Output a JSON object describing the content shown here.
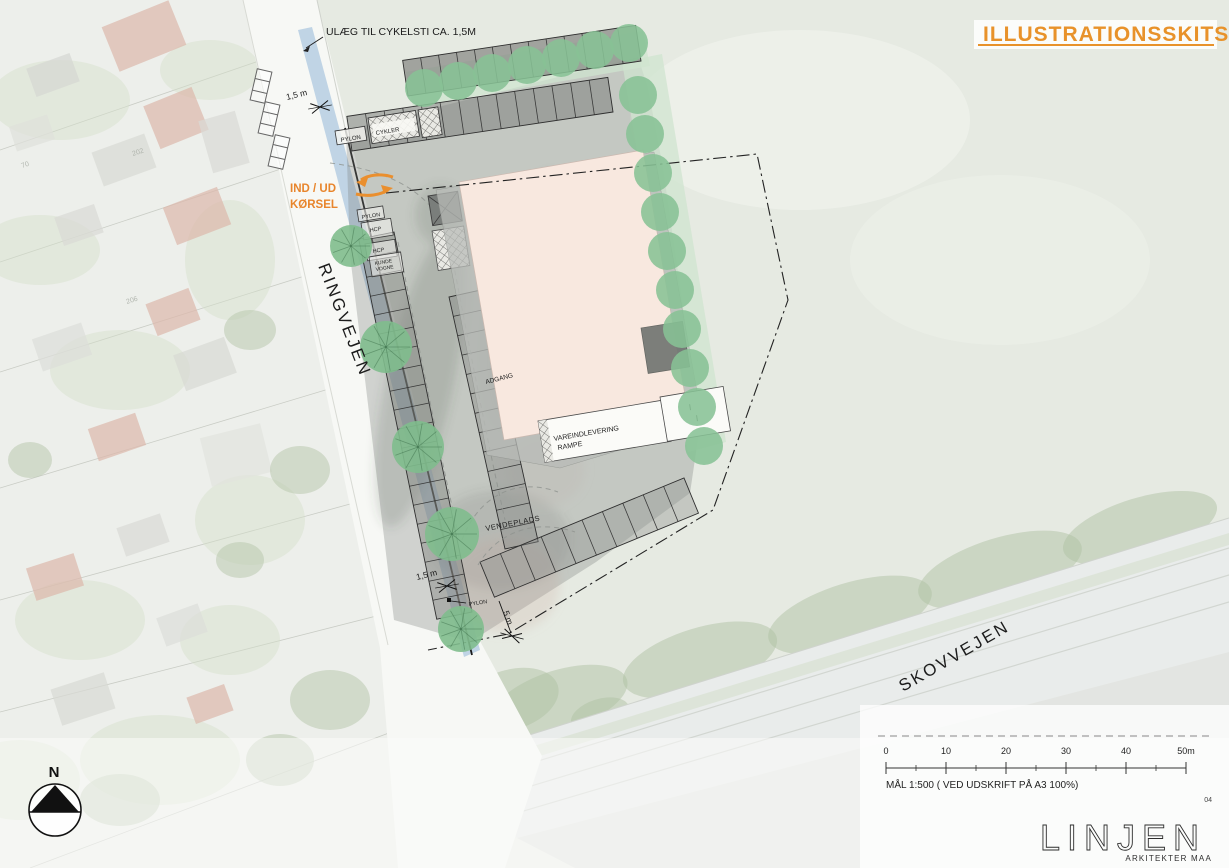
{
  "header": {
    "title": "ILLUSTRATIONSSKITSE",
    "page_number": "04"
  },
  "annotations": {
    "cycle_note": "ULÆG TIL CYKELSTI CA. 1,5M",
    "in_out_line1": "IND / UD",
    "in_out_line2": "KØRSEL",
    "dim_top": "1,5 m",
    "dim_bottom": "1,5 m",
    "dim_pylon": "5 m"
  },
  "roads": {
    "west_road": "RINGVEJEN",
    "south_road": "SKOVVEJEN"
  },
  "site_labels": {
    "pylon_top": "PYLON",
    "cykler": "CYKLER",
    "pylon_west": "PYLON",
    "hcp_1": "HCP",
    "hcp_2": "HCP",
    "kunde_line1": "KUNDE",
    "kunde_line2": "VOGNE",
    "adgang": "ADGANG",
    "delivery_line1": "VAREINDLEVERING",
    "delivery_line2": "RAMPE",
    "vendeplads": "VENDEPLADS",
    "pylon_bottom": "PYLON"
  },
  "footer": {
    "north_label": "N",
    "scale_ticks": [
      "0",
      "10",
      "20",
      "30",
      "40",
      "50m"
    ],
    "scale_caption": "MÅL 1:500 ( VED UDSKRIFT PÅ A3 100%)",
    "logo_text": "LINJEN",
    "logo_sub": "ARKITEKTER MAA"
  },
  "parcel_numbers": [
    {
      "text": "202",
      "x": 133,
      "y": 156,
      "rot": -18
    },
    {
      "text": "70",
      "x": 22,
      "y": 168,
      "rot": -18
    },
    {
      "text": "206",
      "x": 127,
      "y": 304,
      "rot": -18
    }
  ],
  "colors": {
    "accent_orange": "#E8922A",
    "tree_green": "#88C295",
    "tree_band": "#CFE4CF",
    "cycle_blue": "#A8C4DE",
    "building_pink": "#F8E8DF",
    "roof_gray": "#6F7370",
    "road_white": "#F7F8F5",
    "field_green": "#E6EAE2"
  },
  "scene": {
    "parking_rows": [
      {
        "p1": [
          641,
          61
        ],
        "p2": [
          408,
          96
        ],
        "depth": 36,
        "stalls": 13,
        "fill": "rgba(118,120,117,0.62)"
      },
      {
        "p1": [
          613,
          112
        ],
        "p2": [
          352,
          151
        ],
        "depth": 35,
        "stalls": 14,
        "fill": "rgba(128,130,127,0.55)"
      },
      {
        "p1": [
          394,
          232
        ],
        "p2": [
          472,
          612
        ],
        "depth": 36,
        "stalls": 20,
        "fill": "rgba(130,132,129,0.45)"
      },
      {
        "p1": [
          505,
          549
        ],
        "p2": [
          449,
          297
        ],
        "depth": 34,
        "stalls": 13,
        "fill": "rgba(134,136,133,0.42)"
      },
      {
        "p1": [
          480,
          562
        ],
        "p2": [
          684,
          478
        ],
        "depth": 38,
        "stalls": 10,
        "fill": "rgba(146,148,144,0.40)"
      }
    ],
    "tree_radius": 19,
    "trees_row": [
      [
        424,
        88
      ],
      [
        458,
        81
      ],
      [
        492,
        73
      ],
      [
        527,
        65
      ],
      [
        561,
        58
      ],
      [
        595,
        50
      ],
      [
        629,
        43
      ],
      [
        638,
        95
      ],
      [
        645,
        134
      ],
      [
        653,
        173
      ],
      [
        660,
        212
      ],
      [
        667,
        251
      ],
      [
        675,
        290
      ],
      [
        682,
        329
      ],
      [
        690,
        368
      ],
      [
        697,
        407
      ],
      [
        704,
        446
      ]
    ],
    "trees_west": [
      [
        351,
        246,
        21
      ],
      [
        386,
        347,
        26
      ],
      [
        418,
        447,
        26
      ],
      [
        452,
        534,
        27
      ],
      [
        461,
        629,
        23
      ]
    ],
    "houses": [
      [
        108,
        12,
        72,
        48,
        -22,
        "#DCB9AC"
      ],
      [
        30,
        60,
        46,
        30,
        -20,
        "#D6D7D2"
      ],
      [
        150,
        95,
        52,
        46,
        -22,
        "#DCB9AC"
      ],
      [
        96,
        142,
        56,
        36,
        -20,
        "#D8D9D4"
      ],
      [
        12,
        120,
        40,
        26,
        -18,
        "#DFE0DB"
      ],
      [
        205,
        115,
        38,
        54,
        -16,
        "#D9DAD5"
      ],
      [
        168,
        196,
        58,
        40,
        -21,
        "#DCB9AC"
      ],
      [
        58,
        210,
        42,
        30,
        -19,
        "#D9DAD5"
      ],
      [
        150,
        295,
        46,
        34,
        -21,
        "#DCB9AC"
      ],
      [
        36,
        330,
        52,
        34,
        -19,
        "#DDDED9"
      ],
      [
        178,
        345,
        54,
        38,
        -20,
        "#D8D9D4"
      ],
      [
        92,
        420,
        50,
        34,
        -19,
        "#DCB9AC"
      ],
      [
        205,
        430,
        62,
        50,
        -14,
        "#E2E3DE"
      ],
      [
        120,
        520,
        46,
        30,
        -19,
        "#D9DAD5"
      ],
      [
        30,
        560,
        50,
        34,
        -18,
        "#DCB9AC"
      ],
      [
        160,
        610,
        44,
        30,
        -20,
        "#DDDED9"
      ],
      [
        55,
        680,
        56,
        38,
        -18,
        "#D8D9D4"
      ],
      [
        190,
        690,
        40,
        28,
        -20,
        "#DCB9AC"
      ]
    ],
    "parcel_lines": [
      [
        0,
        150,
        285,
        52
      ],
      [
        0,
        262,
        308,
        160
      ],
      [
        0,
        372,
        330,
        268
      ],
      [
        0,
        488,
        352,
        382
      ],
      [
        0,
        600,
        372,
        498
      ],
      [
        0,
        712,
        392,
        612
      ],
      [
        30,
        868,
        410,
        725
      ]
    ],
    "yard_patches": [
      [
        60,
        100,
        70,
        40
      ],
      [
        210,
        70,
        50,
        30
      ],
      [
        40,
        250,
        60,
        35
      ],
      [
        230,
        260,
        45,
        60
      ],
      [
        120,
        370,
        70,
        40
      ],
      [
        250,
        520,
        55,
        45
      ],
      [
        80,
        620,
        65,
        40
      ],
      [
        230,
        640,
        50,
        35
      ],
      [
        160,
        760,
        80,
        45
      ],
      [
        20,
        780,
        60,
        40
      ]
    ],
    "tree_blobs": [
      [
        250,
        330,
        26,
        20
      ],
      [
        300,
        470,
        30,
        24
      ],
      [
        240,
        560,
        24,
        18
      ],
      [
        330,
        700,
        40,
        30
      ],
      [
        280,
        760,
        34,
        26
      ],
      [
        120,
        800,
        40,
        26
      ],
      [
        30,
        460,
        22,
        18
      ]
    ],
    "hedge_blobs": [
      [
        560,
        700,
        70,
        30
      ],
      [
        700,
        660,
        80,
        32
      ],
      [
        850,
        615,
        85,
        32
      ],
      [
        1000,
        570,
        85,
        32
      ],
      [
        1140,
        528,
        80,
        30
      ],
      [
        620,
        740,
        60,
        24
      ],
      [
        760,
        700,
        70,
        26
      ],
      [
        920,
        650,
        75,
        28
      ],
      [
        1080,
        600,
        70,
        26
      ],
      [
        1190,
        565,
        50,
        22
      ],
      [
        510,
        700,
        50,
        30
      ],
      [
        600,
        715,
        30,
        16
      ],
      [
        780,
        680,
        34,
        18
      ],
      [
        950,
        625,
        36,
        18
      ],
      [
        1110,
        575,
        32,
        16
      ]
    ],
    "lane_lines": [
      [
        470,
        782,
        1229,
        548
      ],
      [
        485,
        800,
        1229,
        575
      ],
      [
        500,
        818,
        1229,
        602
      ]
    ],
    "scalebar": {
      "x0": 886,
      "y": 768,
      "step": 60,
      "majors": 6
    }
  }
}
